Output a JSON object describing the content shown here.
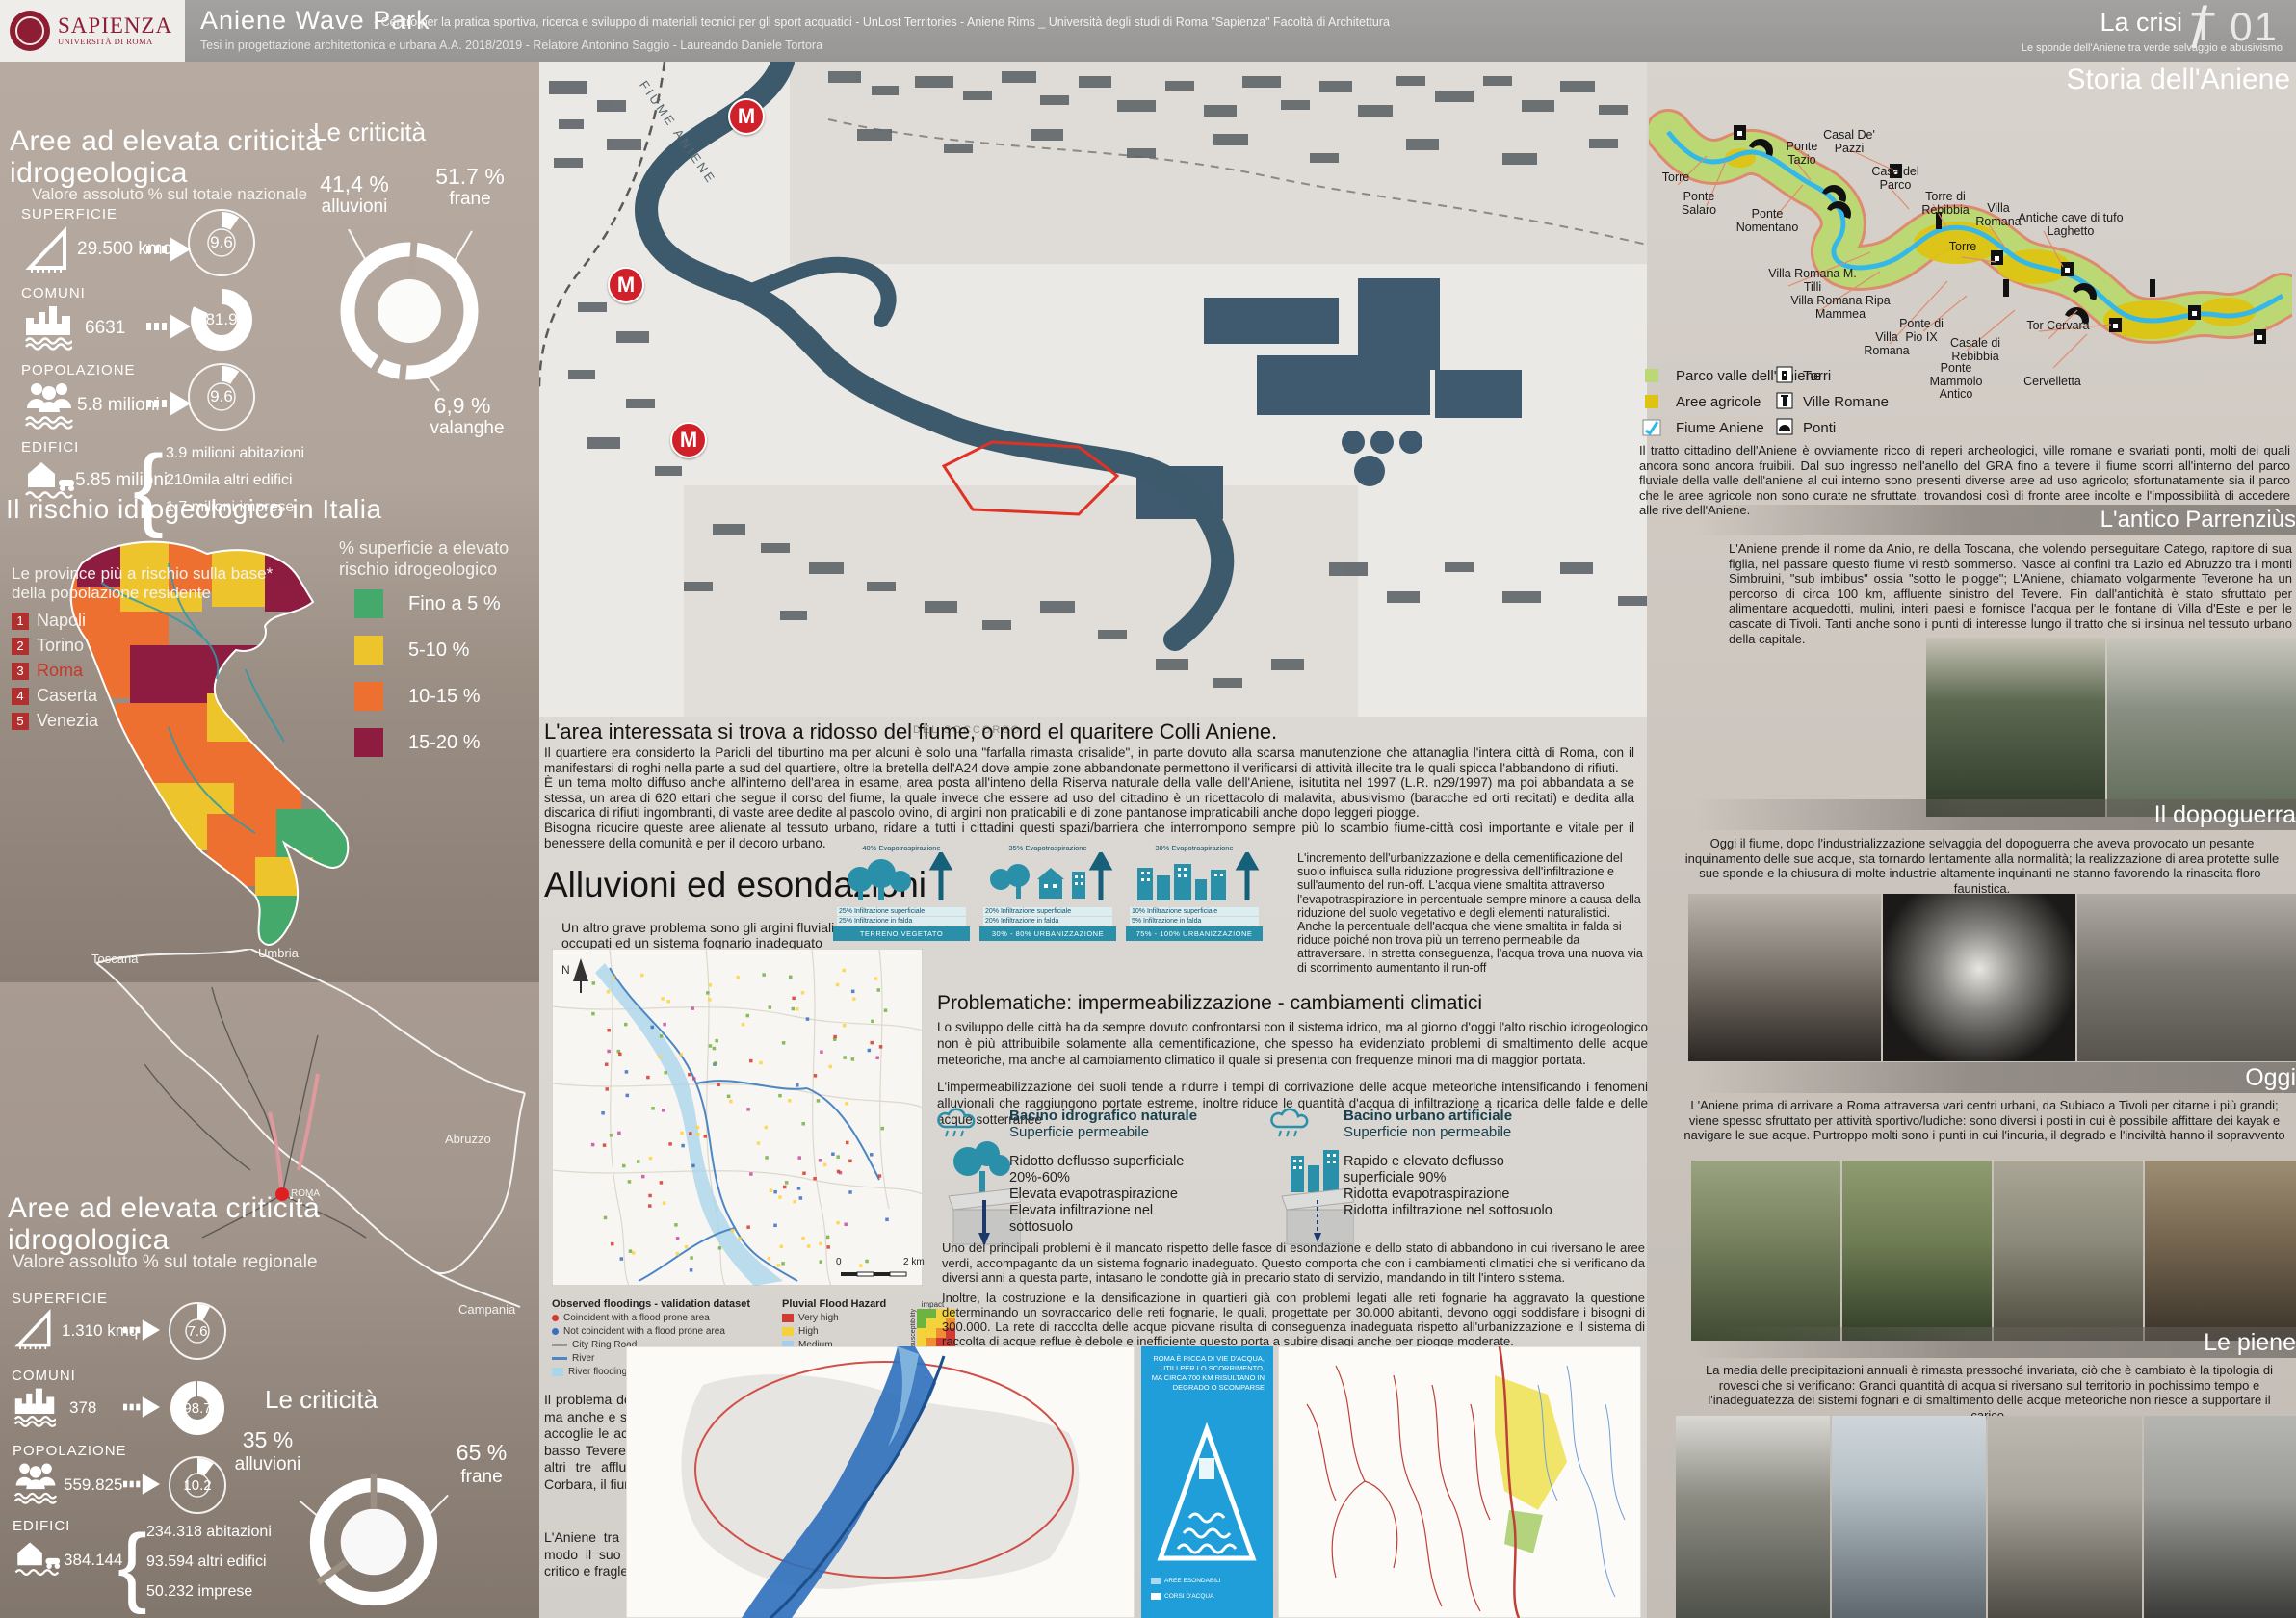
{
  "header": {
    "logo_name": "SAPIENZA",
    "logo_sub": "UNIVERSITÀ DI ROMA",
    "title": "Aniene Wave Park",
    "subtitle": "- Centro per la pratica sportiva, ricerca e sviluppo di materiali tecnici per gli sport acquatici - UnLost Territories - Aniene Rims _ Università degli studi di Roma \"Sapienza\" Facoltà di Architettura",
    "subtitle2": "Tesi in progettazione architettonica e urbana A.A. 2018/2019 - Relatore Antonino Saggio - Laureando Daniele Tortora",
    "crisis": "La crisi",
    "slash": "/",
    "sheet": "T 01",
    "crisis_sub": "Le sponde dell'Aniene tra verde selvaggio e abusivismo"
  },
  "national": {
    "title": "Aree ad elevata criticità idrogeologica",
    "subtitle": "Valore assoluto % sul totale nazionale",
    "superficie": {
      "label": "SUPERFICIE",
      "value": "29.500 kmq",
      "pct": "9.6"
    },
    "comuni": {
      "label": "COMUNI",
      "value": "6631",
      "pct": "81.9"
    },
    "popolazione": {
      "label": "POPOLAZIONE",
      "value": "5.8 milioni",
      "pct": "9.6"
    },
    "edifici": {
      "label": "EDIFICI",
      "value": "5.85 milioni",
      "b1": "3.9 milioni abitazioni",
      "b2": "210mila altri edifici",
      "b3": "1.7 milioni imprese"
    },
    "criticita": {
      "title": "Le criticità",
      "v1": "41,4 %",
      "l1": "alluvioni",
      "v2": "51.7 %",
      "l2": "frane",
      "v3": "6,9 %",
      "l3": "valanghe"
    }
  },
  "italia": {
    "title": "Il rischio idrogeologico in Italia",
    "legend_title": "% superficie a elevato rischio",
    "legend_title2": "idrogeologico",
    "leg1": "Fino a 5 %",
    "leg2": "5-10 %",
    "leg3": "10-15 %",
    "leg4": "15-20 %",
    "prov_title": "Le province più a rischio sulla base*",
    "prov_title2": "della popolazione residente",
    "r1": "1",
    "p1": "Napoli",
    "r2": "2",
    "p2": "Torino",
    "r3": "3",
    "p3": "Roma",
    "r4": "4",
    "p4": "Caserta",
    "r5": "5",
    "p5": "Venezia",
    "toscana": "Toscana",
    "umbria": "Umbria",
    "abruzzo": "Abruzzo",
    "campania": "Campania",
    "roma": "ROMA"
  },
  "regional": {
    "title": "Aree ad elevata criticità idrogologica",
    "subtitle": "Valore assoluto % sul totale regionale",
    "superficie": {
      "label": "SUPERFICIE",
      "value": "1.310 kmq",
      "pct": "7.6"
    },
    "comuni": {
      "label": "COMUNI",
      "value": "378",
      "pct": "98.7"
    },
    "popolazione": {
      "label": "POPOLAZIONE",
      "value": "559.825",
      "pct": "10.2"
    },
    "edifici": {
      "label": "EDIFICI",
      "value": "384.144",
      "b1": "234.318 abitazioni",
      "b2": "93.594 altri edifici",
      "b3": "50.232 imprese"
    },
    "criticita": {
      "title": "Le criticità",
      "v1": "35 %",
      "l1": "alluvioni",
      "v2": "65 %",
      "l2": "frane"
    }
  },
  "citymap": {
    "fiume": "FIUME ANIENE",
    "metro": "M",
    "toponym": "DEL SOCCORSO"
  },
  "area": {
    "title": "L'area interessata si trova a ridosso del fiume, o nord el quaritere Colli Aniene.",
    "p1": "Il quartiere era considerto la Parioli del tiburtino ma per alcuni è solo una \"farfalla rimasta crisalide\", in parte dovuto alla scarsa manutenzione che attanaglia l'intera città di Roma, con il manifestarsi di roghi nella parte a sud del quartiere, oltre la bretella dell'A24 dove ampie zone abbandonate permettono il verificarsi di attività illecite tra le quali spicca l'abbandono di rifiuti.",
    "p2": "È un tema molto diffuso anche all'interno dell'area in esame, area posta all'inteno della Riserva naturale della valle dell'Aniene, isitutita nel 1997 (L.R. n29/1997) ma poi abbandata a se stessa, un area di 620 ettari che segue il corso del fiume, la quale invece che essere ad uso del cittadino è un ricettacolo di malavita, abusivismo (baracche ed orti recitati) e dedita alla discarica di rifiuti ingombranti, di vaste aree dedite al pascolo ovino, di argini non praticabili e di zone pantanose impraticabili anche dopo leggeri piogge.",
    "p3": "Bisogna ricucire queste aree alienate al tessuto urbano, ridare a tutti i cittadini questi spazi/barriera che interrompono sempre più lo scambio fiume-città così importante e vitale per il benessere della comunità e per il decoro urbano."
  },
  "alluvioni": {
    "title": "Alluvioni ed esondazioni",
    "note": "Un altro grave problema sono gli argini fluviali occupati ed un sistema fognario inadeguato",
    "legend": {
      "obs_title": "Observed floodings - validation dataset",
      "obs1": "Coincident with a flood prone area",
      "obs2": "Not coincident with a flood prone area",
      "obs3": "City Ring Road",
      "obs4": "River",
      "obs5": "River flooding hazard",
      "pluvial_title": "Pluvial Flood Hazard",
      "pl1": "Very high",
      "pl2": "High",
      "pl3": "Medium",
      "pl4": "Low",
      "pl5": "Negligible",
      "matrix": {
        "impact": "impact",
        "susceptibility": "susceptibility",
        "n1": "1",
        "n2": "2",
        "n3": "3",
        "n4": "4"
      },
      "scale0": "0",
      "scale2": "2 km",
      "north": "N"
    }
  },
  "urb": {
    "d1": {
      "top": "40% Evapotraspirazione",
      "m1": "25% Infiltrazione superficiale",
      "m2": "25% Infiltrazione in falda",
      "label": "TERRENO VEGETATO"
    },
    "d2": {
      "top": "35% Evapotraspirazione",
      "m1": "20% Infiltrazione superficiale",
      "m2": "20% Infiltrazione in falda",
      "label": "30% - 80% URBANIZZAZIONE"
    },
    "d3": {
      "top": "30% Evapotraspirazione",
      "m1": "10% Infiltrazione superficiale",
      "m2": "5% Infiltrazione in falda",
      "label": "75% - 100% URBANIZZAZIONE"
    },
    "text": "L'incremento dell'urbanizzazione e della cementificazione del suolo influisca sulla riduzione progressiva dell'infiltrazione e sull'aumento del run-off. L'acqua viene smaltita attraverso l'evapotraspirazione in percentuale sempre minore a causa della riduzione del suolo vegetativo e degli elementi naturalistici. Anche la percentuale dell'acqua che viene smaltita in falda si riduce poiché non trova più un terreno permeabile da attraversare. In stretta conseguenza, l'acqua trova una nuova via di scorrimento aumentanto il run-off"
  },
  "problematiche": {
    "title": "Problematiche: impermeabilizzazione - cambiamenti climatici",
    "p1": "Lo sviluppo delle città ha da sempre dovuto confrontarsi con il sistema idrico, ma al giorno d'oggi l'alto rischio idrogeologico non è più attribuibile solamente alla cementificazione, che spesso ha evidenziato problemi di smaltimento delle acque meteoriche, ma anche al cambiamento climatico il quale si presenta con frequenze minori ma di maggior portata.",
    "p2": "L'impermeabilizzazione dei suoli tende a ridurre i tempi di corrivazione delle acque meteoriche intensificando i fenomeni alluvionali che raggiungono portate estreme, inoltre riduce le quantità d'acqua di infiltrazione a ricarica delle falde e delle acque sotterranee",
    "nat_t1": "Bacino idrografico naturale",
    "nat_t2": "Superficie permeabile",
    "nat_i1": "Ridotto deflusso superficiale 20%-60%",
    "nat_i2": "Elevata evapotraspirazione",
    "nat_i3": "Elevata infiltrazione nel sottosuolo",
    "urb_t1": "Bacino urbano artificiale",
    "urb_t2": "Superficie non permeabile",
    "urb_i1": "Rapido e elevato deflusso superficiale 90%",
    "urb_i2": "Ridotta evapotraspirazione",
    "urb_i3": "Ridotta infiltrazione nel sottosuolo",
    "p3": "Uno dei principali problemi è il mancato rispetto delle fasce di esondazione e dello stato di abbandono in cui riversano le aree verdi, accompaganto da un sistema fognario inadeguato. Questo comporta che con i cambiamenti climatici che si verificano da diversi anni a questa parte, intasano le condotte già in precario stato di servizio, mandando in tilt l'intero sistema.",
    "p4": "Inoltre, la costruzione e la densificazione in quartieri già con problemi legati alle reti fognarie ha aggravato la questione determinando un sovraccarico delle reti fognarie, le quali, progettate per 30.000 abitanti, devono oggi soddisfare i bisogni di 300.000. La rete di raccolta delle acque piovane risulta di conseguenza inadeguata rispetto all'urbanizzazione e il sistema di raccolta di acque reflue è debole e inefficiente questo porta a subire disagi anche per piogge moderate."
  },
  "tevere": {
    "p1": "Il problema delle esondazioni non riguarda ovviamente solo l'Aniene ma anche e soprattutto il fiume Tevere, il quale lungo il suo percorso accoglie le acque di molti corsi d'acqua; uno principale costituito dal basso Tevere e dall'asta fluviale del fiume Paglia che riceve poi gli altri tre affluenti costituiti dall'alto Tevere sotteso dalla diga di Corbara, il fiume Nera e il fiume Aniene.",
    "p2": "L'Aniene tra questi è quello che mostra più criticità, in particolar modo il suo punto di confluenza nel Tevere risulta essere molto critico e fragle a causa di problemi strutturali."
  },
  "bluepanel": {
    "text": "ROMA È RICCA DI VIE D'ACQUA, UTILI PER LO SCORRIMENTO, MA CIRCA 700 KM RISULTANO IN DEGRADO O SCOMPARSE",
    "leg1": "AREE ESONDABILI",
    "leg2": "CORSI D'ACQUA"
  },
  "storia": {
    "title": "Storia dell'Aniene",
    "labels": [
      "Torre",
      "Ponte Salaro",
      "Ponte Nomentano",
      "Ponte Tazio",
      "Casal De' Pazzi",
      "Casa del Parco",
      "Torre di Rebibbia",
      "Villa Romana M. Tilli",
      "Villa Romana Ripa Mammea",
      "Torre",
      "Villa Romana",
      "Antiche cave di tufo Laghetto",
      "Villa Romana",
      "Ponte di Pio IX",
      "Casale di Rebibbia",
      "Ponte Mammolo Antico",
      "Tor Cervara",
      "Cervelletta"
    ],
    "leg_parco": "Parco valle dell'Aniene",
    "leg_agricole": "Aree agricole",
    "leg_fiume": "Fiume Aniene",
    "leg_torri": "Torri",
    "leg_ville": "Ville Romane",
    "leg_ponti": "Ponti",
    "text": "Il tratto cittadino dell'Aniene è ovviamente ricco di reperi archeologici, ville romane e svariati ponti, molti dei quali ancora sono ancora fruibili. Dal suo ingresso nell'anello del GRA fino a tevere il fiume scorri all'interno del parco fluviale della valle dell'aniene al cui interno sono presenti diverse aree ad uso agricolo; sfortunatamente sia il parco che le aree agricole non sono curate ne sfruttate, trovandosi così di fronte aree incolte e l'impossibilità di accedere alle rive dell'Aniene."
  },
  "antico": {
    "title": "L'antico Parrenziùs",
    "text": "L'Aniene prende il nome da Anio, re della Toscana, che volendo perseguitare Catego, rapitore di sua figlia, nel passare questo fiume vi restò sommerso. Nasce ai confini tra Lazio ed Abruzzo tra i monti Simbruini, \"sub imbibus\" ossia \"sotto le piogge\"; L'Aniene, chiamato volgarmente Teverone ha un percorso di circa 100 km, affluente sinistro del Tevere. Fin dall'antichità è stato sfruttato per alimentare acquedotti, mulini, interi paesi e fornisce l'acqua per le fontane di Villa d'Este e per le cascate di Tivoli.  Tanti anche sono i punti di interesse lungo il tratto che si insinua nel tessuto urbano della capitale."
  },
  "dopoguerra": {
    "title": "Il dopoguerra",
    "text": "Oggi il fiume, dopo l'industrializzazione selvaggia del dopoguerra che aveva provocato un pesante inquinamento delle sue acque, sta tornardo lentamente alla normalità; la realizzazione di area protette sulle sue sponde e la chiusura di molte industrie altamente inquinanti ne stanno favorendo la rinascita floro-faunistica."
  },
  "oggi": {
    "title": "Oggi",
    "text": "L'Aniene prima di arrivare a Roma attraversa vari centri urbani, da Subiaco a Tivoli per citarne i più grandi; viene spesso sfruttato per attività sportivo/ludiche: sono diversi i posti in cui è possibile affittare dei kayak e navigare le sue acque. Purtroppo molti sono i punti in cui l'incuria, il degrado e l'inciviltà hanno il sopravvento"
  },
  "piene": {
    "title": "Le piene",
    "text": "La media delle precipitazioni annuali è rimasta pressoché invariata, ciò che è cambiato è la tipologia di rovesci che si verificano: Grandi quantità di acqua si riversano sul territorio in pochissimo tempo e l'inadeguatezza dei sistemi fognari e di smaltimento delle acque meteoriche non riesce a supportare il carico.",
    "colors_note": ""
  },
  "colors": {
    "accent_red": "#8c1d33",
    "teal": "#2a8fa8",
    "blue_panel": "#1f9ed9",
    "risk_green": "#45a96b",
    "risk_yellow": "#eec42d",
    "risk_orange": "#ee7030",
    "risk_red": "#8e1c40",
    "parco_green": "#bcd874",
    "agricole_yellow": "#ddc413",
    "river_cyan": "#35b8e8",
    "metro_red": "#d0202a"
  }
}
